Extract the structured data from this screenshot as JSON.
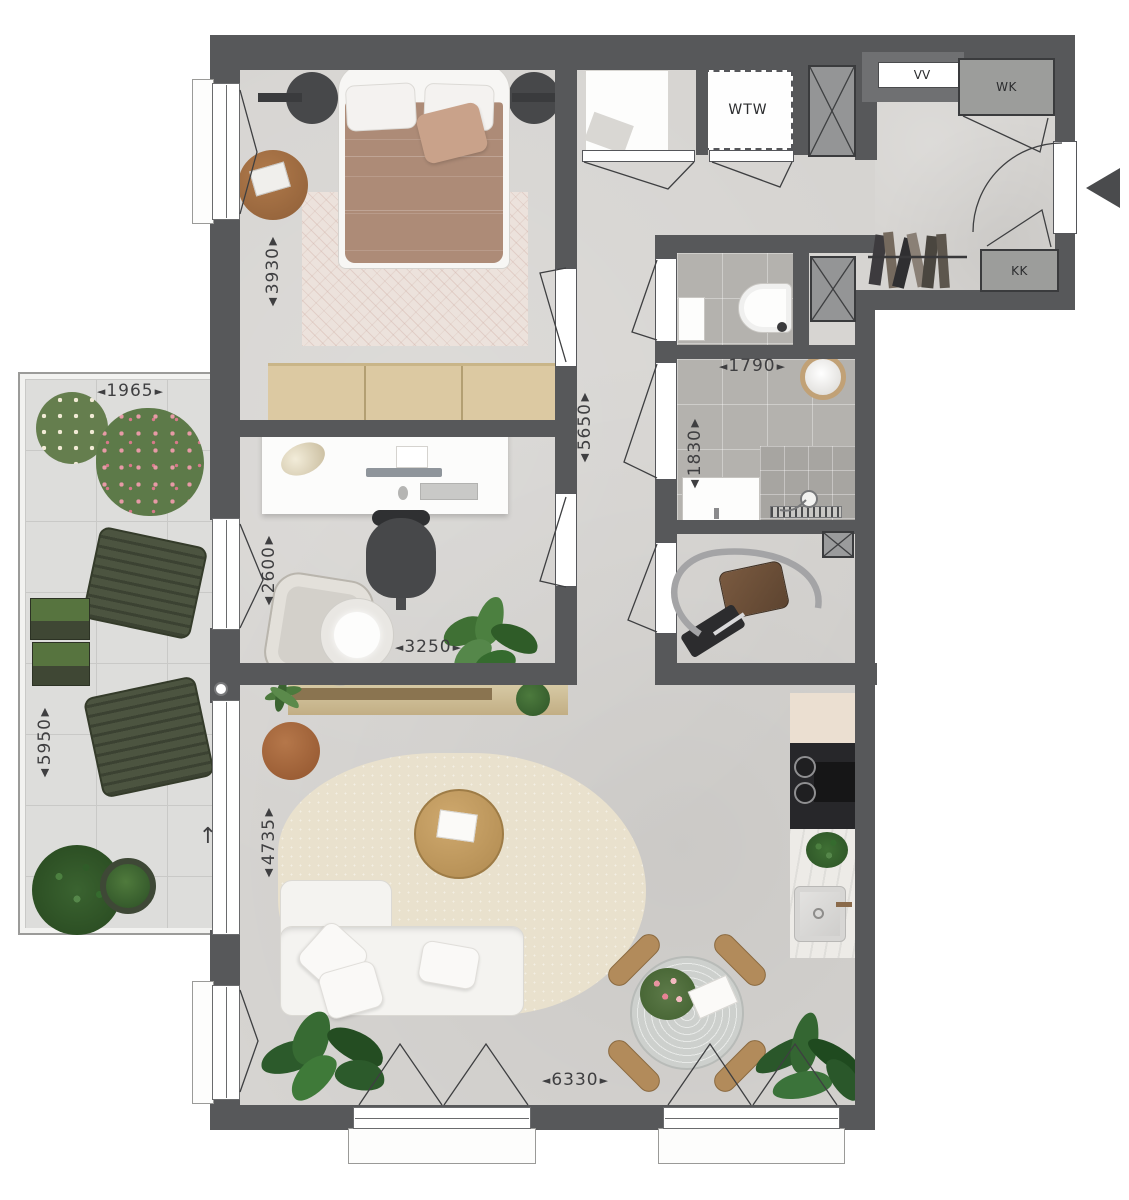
{
  "title": "apartment-floor-plan",
  "glyphs": {
    "left": "◄",
    "right": "►",
    "up": "▲",
    "down": "▼",
    "north": "↑"
  },
  "closets": {
    "vv": "VV",
    "wk": "WK",
    "kk": "KK",
    "wtw": "WTW"
  },
  "dims": {
    "bedroom_depth": "3930",
    "corridor_len": "5650",
    "bath_w": "1790",
    "bath_h": "1830",
    "office_h": "2600",
    "office_w": "3250",
    "balcony_w": "1965",
    "balcony_h": "5950",
    "living_h": "4735",
    "living_w": "6330"
  },
  "colors": {
    "wall": "#57585a",
    "floor": "#d6d4d1",
    "bath_tile": "#b4b2ae",
    "balcony_tile": "#dddddb",
    "wood": "#dcc9a2",
    "duvet": "#ad8b77",
    "sofa": "#f4f3f0",
    "rug_living": "#e9e1cd",
    "rug_bedroom": "#ece2dc",
    "balcony_furniture": "#4c5440",
    "dim_text": "#3f3f41"
  }
}
